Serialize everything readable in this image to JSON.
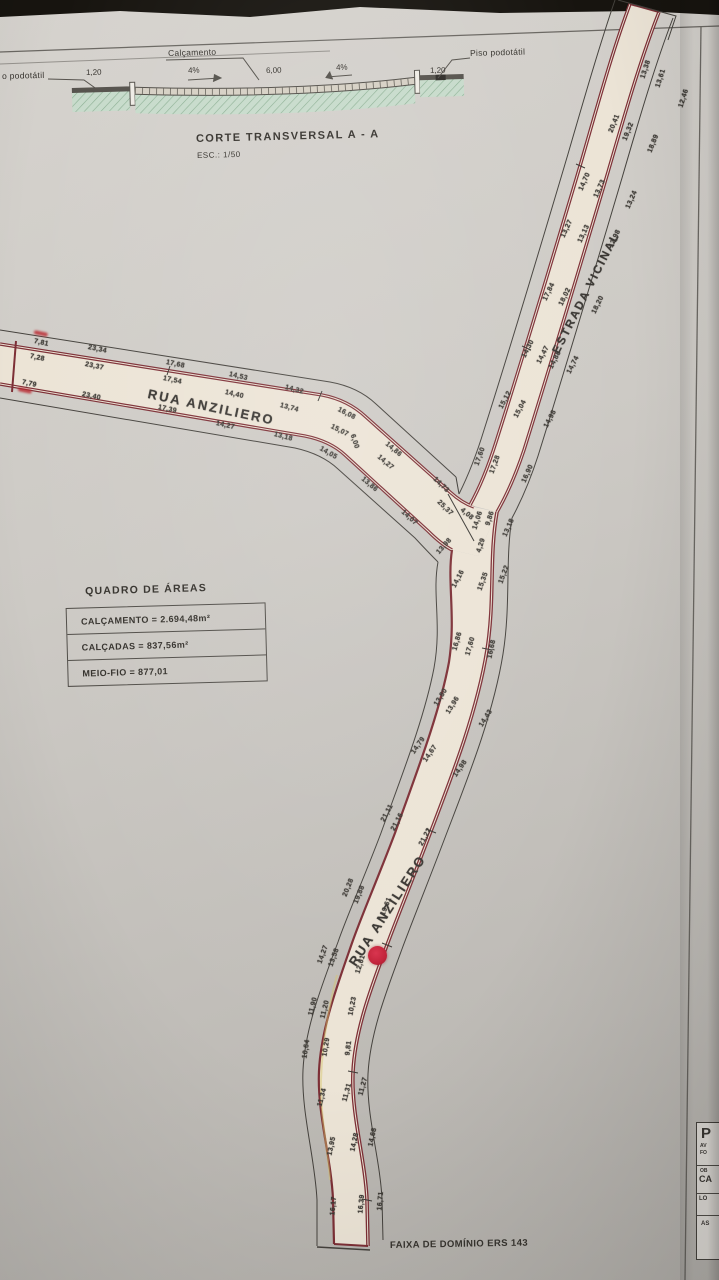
{
  "cross_section": {
    "label_left_cut": "o podotátil",
    "dim_left": "1,20",
    "label_calcamento": "Calçamento",
    "slope_left": "4%",
    "dim_center": "6,00",
    "slope_right": "4%",
    "dim_right": "1,20",
    "label_piso": "Piso podotátil",
    "title": "CORTE TRANSVERSAL A - A",
    "scale": "ESC.: 1/50"
  },
  "areas_table": {
    "title": "QUADRO DE ÁREAS",
    "rows": [
      "CALÇAMENTO = 2.694,48m²",
      "CALÇADAS = 837,56m²",
      "MEIO-FIO = 877,01"
    ]
  },
  "plan": {
    "bottom_label": {
      "text": "FAIXA DE DOMÍNIO ERS 143"
    },
    "road_labels": [
      {
        "text": "RUA ANZILIERO",
        "x": 148,
        "y": 386,
        "r": 12,
        "size": 13,
        "ls": 2.2
      },
      {
        "text": "ESTRADA VICINAL",
        "x": 556,
        "y": 347,
        "r": -63,
        "size": 11.5,
        "ls": 2
      },
      {
        "text": "RUA ANZILIERO",
        "x": 352,
        "y": 957,
        "r": -57,
        "size": 13,
        "ls": 2.2
      }
    ],
    "marks": [
      {
        "x": 34,
        "y": 330,
        "r": 12
      },
      {
        "x": 18,
        "y": 387,
        "r": 12
      }
    ],
    "dimensions": [
      {
        "t": "7,81",
        "x": 34,
        "y": 338,
        "r": 12
      },
      {
        "t": "7,28",
        "x": 30,
        "y": 353,
        "r": 12
      },
      {
        "t": "7,79",
        "x": 22,
        "y": 379,
        "r": 12
      },
      {
        "t": "23,34",
        "x": 88,
        "y": 344,
        "r": 12
      },
      {
        "t": "23,37",
        "x": 85,
        "y": 361,
        "r": 12
      },
      {
        "t": "23,40",
        "x": 82,
        "y": 391,
        "r": 12
      },
      {
        "t": "17,68",
        "x": 166,
        "y": 359,
        "r": 12
      },
      {
        "t": "17,54",
        "x": 163,
        "y": 375,
        "r": 12
      },
      {
        "t": "17,39",
        "x": 158,
        "y": 404,
        "r": 12
      },
      {
        "t": "14,53",
        "x": 229,
        "y": 371,
        "r": 13
      },
      {
        "t": "14,40",
        "x": 225,
        "y": 389,
        "r": 13
      },
      {
        "t": "14,27",
        "x": 216,
        "y": 420,
        "r": 13
      },
      {
        "t": "14,32",
        "x": 285,
        "y": 384,
        "r": 15
      },
      {
        "t": "13,74",
        "x": 280,
        "y": 402,
        "r": 15
      },
      {
        "t": "13,18",
        "x": 274,
        "y": 431,
        "r": 15
      },
      {
        "t": "16,08",
        "x": 338,
        "y": 406,
        "r": 27
      },
      {
        "t": "15,07",
        "x": 331,
        "y": 423,
        "r": 27
      },
      {
        "t": "14,05",
        "x": 320,
        "y": 445,
        "r": 30
      },
      {
        "t": "6,00",
        "x": 352,
        "y": 431,
        "r": 72
      },
      {
        "t": "14,86",
        "x": 386,
        "y": 440,
        "r": 40
      },
      {
        "t": "14,27",
        "x": 378,
        "y": 453,
        "r": 40
      },
      {
        "t": "13,86",
        "x": 362,
        "y": 475,
        "r": 40
      },
      {
        "t": "14,73",
        "x": 434,
        "y": 475,
        "r": 44
      },
      {
        "t": "25,37",
        "x": 438,
        "y": 498,
        "r": 44
      },
      {
        "t": "14,07",
        "x": 402,
        "y": 508,
        "r": 42
      },
      {
        "t": "4,08",
        "x": 461,
        "y": 506,
        "r": 40
      },
      {
        "t": "17,60",
        "x": 477,
        "y": 462,
        "r": -70
      },
      {
        "t": "17,28",
        "x": 492,
        "y": 470,
        "r": -70
      },
      {
        "t": "16,90",
        "x": 524,
        "y": 479,
        "r": -66
      },
      {
        "t": "14,06",
        "x": 475,
        "y": 526,
        "r": -72
      },
      {
        "t": "9,86",
        "x": 488,
        "y": 522,
        "r": -72
      },
      {
        "t": "4,29",
        "x": 479,
        "y": 549,
        "r": -72
      },
      {
        "t": "13,18",
        "x": 505,
        "y": 533,
        "r": -66
      },
      {
        "t": "13,98",
        "x": 438,
        "y": 550,
        "r": -48
      },
      {
        "t": "14,16",
        "x": 454,
        "y": 584,
        "r": -62
      },
      {
        "t": "15,35",
        "x": 480,
        "y": 587,
        "r": -70
      },
      {
        "t": "15,22",
        "x": 501,
        "y": 580,
        "r": -70
      },
      {
        "t": "15,12",
        "x": 501,
        "y": 405,
        "r": -62
      },
      {
        "t": "15,04",
        "x": 516,
        "y": 414,
        "r": -62
      },
      {
        "t": "14,98",
        "x": 546,
        "y": 424,
        "r": -62
      },
      {
        "t": "14,30",
        "x": 524,
        "y": 354,
        "r": -63
      },
      {
        "t": "14,47",
        "x": 539,
        "y": 360,
        "r": -63
      },
      {
        "t": "14,88",
        "x": 551,
        "y": 365,
        "r": -63
      },
      {
        "t": "14,74",
        "x": 569,
        "y": 370,
        "r": -63
      },
      {
        "t": "17,84",
        "x": 545,
        "y": 297,
        "r": -64
      },
      {
        "t": "18,02",
        "x": 561,
        "y": 302,
        "r": -64
      },
      {
        "t": "18,20",
        "x": 594,
        "y": 310,
        "r": -64
      },
      {
        "t": "13,27",
        "x": 563,
        "y": 234,
        "r": -65
      },
      {
        "t": "13,13",
        "x": 580,
        "y": 239,
        "r": -65
      },
      {
        "t": "12,98",
        "x": 611,
        "y": 244,
        "r": -65
      },
      {
        "t": "14,70",
        "x": 581,
        "y": 187,
        "r": -66
      },
      {
        "t": "13,73",
        "x": 596,
        "y": 194,
        "r": -66
      },
      {
        "t": "13,24",
        "x": 628,
        "y": 205,
        "r": -66
      },
      {
        "t": "20,41",
        "x": 611,
        "y": 129,
        "r": -68
      },
      {
        "t": "19,32",
        "x": 625,
        "y": 137,
        "r": -68
      },
      {
        "t": "18,89",
        "x": 650,
        "y": 149,
        "r": -68
      },
      {
        "t": "13,38",
        "x": 643,
        "y": 75,
        "r": -72
      },
      {
        "t": "13,61",
        "x": 658,
        "y": 84,
        "r": -72
      },
      {
        "t": "12,46",
        "x": 681,
        "y": 104,
        "r": -72
      },
      {
        "t": "16,86",
        "x": 455,
        "y": 647,
        "r": -74
      },
      {
        "t": "17,60",
        "x": 468,
        "y": 652,
        "r": -74
      },
      {
        "t": "16,68",
        "x": 490,
        "y": 655,
        "r": -78
      },
      {
        "t": "13,80",
        "x": 436,
        "y": 702,
        "r": -58
      },
      {
        "t": "13,96",
        "x": 448,
        "y": 710,
        "r": -58
      },
      {
        "t": "14,43",
        "x": 481,
        "y": 723,
        "r": -58
      },
      {
        "t": "14,79",
        "x": 413,
        "y": 750,
        "r": -55
      },
      {
        "t": "14,67",
        "x": 425,
        "y": 758,
        "r": -55
      },
      {
        "t": "14,98",
        "x": 455,
        "y": 773,
        "r": -55
      },
      {
        "t": "21,11",
        "x": 383,
        "y": 818,
        "r": -62
      },
      {
        "t": "21,16",
        "x": 393,
        "y": 827,
        "r": -62
      },
      {
        "t": "21,22",
        "x": 421,
        "y": 842,
        "r": -62
      },
      {
        "t": "20,28",
        "x": 345,
        "y": 893,
        "r": -68
      },
      {
        "t": "19,88",
        "x": 356,
        "y": 900,
        "r": -68
      },
      {
        "t": "19,61",
        "x": 383,
        "y": 912,
        "r": -68
      },
      {
        "t": "14,27",
        "x": 320,
        "y": 960,
        "r": -70
      },
      {
        "t": "13,58",
        "x": 331,
        "y": 963,
        "r": -70
      },
      {
        "t": "12,61",
        "x": 358,
        "y": 970,
        "r": -73
      },
      {
        "t": "11,90",
        "x": 311,
        "y": 1012,
        "r": -76
      },
      {
        "t": "11,20",
        "x": 323,
        "y": 1015,
        "r": -76
      },
      {
        "t": "10,23",
        "x": 351,
        "y": 1012,
        "r": -79
      },
      {
        "t": "10,64",
        "x": 305,
        "y": 1055,
        "r": -81
      },
      {
        "t": "10,29",
        "x": 325,
        "y": 1053,
        "r": -81
      },
      {
        "t": "9,81",
        "x": 348,
        "y": 1052,
        "r": -83
      },
      {
        "t": "11,34",
        "x": 320,
        "y": 1103,
        "r": -75
      },
      {
        "t": "11,31",
        "x": 345,
        "y": 1098,
        "r": -75
      },
      {
        "t": "11,27",
        "x": 361,
        "y": 1092,
        "r": -75
      },
      {
        "t": "13,95",
        "x": 330,
        "y": 1152,
        "r": -78
      },
      {
        "t": "14,28",
        "x": 353,
        "y": 1148,
        "r": -78
      },
      {
        "t": "14,68",
        "x": 371,
        "y": 1143,
        "r": -78
      },
      {
        "t": "16,17",
        "x": 333,
        "y": 1212,
        "r": -85
      },
      {
        "t": "16,39",
        "x": 361,
        "y": 1210,
        "r": -85
      },
      {
        "t": "16,71",
        "x": 380,
        "y": 1207,
        "r": -85
      }
    ]
  },
  "title_block": {
    "fragments": [
      "P",
      "AV",
      "FO",
      "OB",
      "CA",
      "LO",
      "AS"
    ]
  },
  "colors": {
    "road_edge": "#7d2f36",
    "road_fill": "#ece4d6",
    "marker": "#c2233b",
    "ground_green": "#c7dbcb"
  }
}
